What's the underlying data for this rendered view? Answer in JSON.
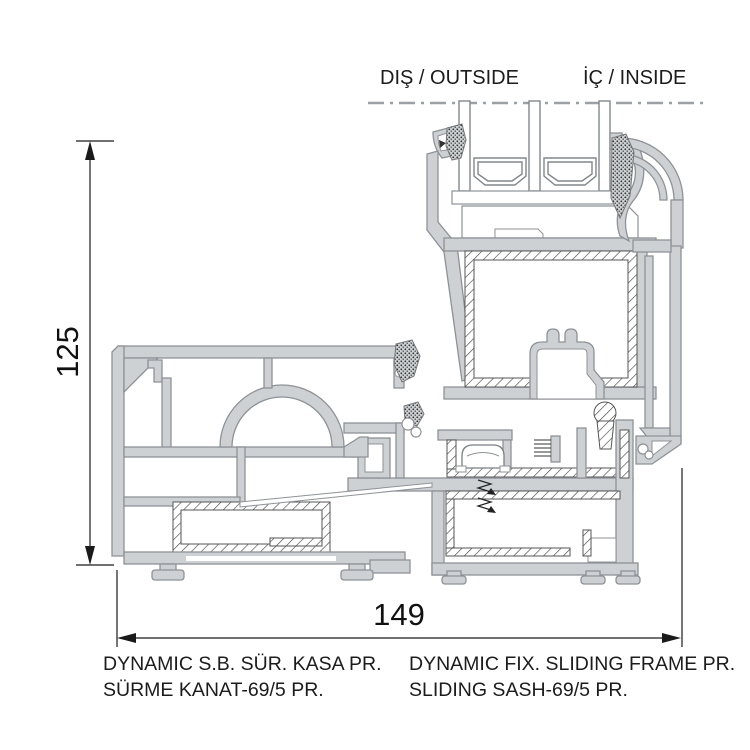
{
  "labels": {
    "outside": "DIŞ / OUTSIDE",
    "inside": "İÇ / INSIDE"
  },
  "dimensions": {
    "height_mm": "125",
    "width_mm": "149"
  },
  "footer": {
    "left_line1": "DYNAMIC S.B. SÜR. KASA PR.",
    "left_line2": "SÜRME KANAT-69/5 PR.",
    "right_line1": "DYNAMIC FIX. SLIDING FRAME PR.",
    "right_line2": "SLIDING SASH-69/5 PR."
  },
  "colors": {
    "background": "#ffffff",
    "profile_fill": "#cdd1d4",
    "profile_stroke": "#8e9296",
    "hatch_line": "#4a4a4a",
    "dimension_line": "#1a1a1a",
    "centerline": "#9aa0a3"
  }
}
